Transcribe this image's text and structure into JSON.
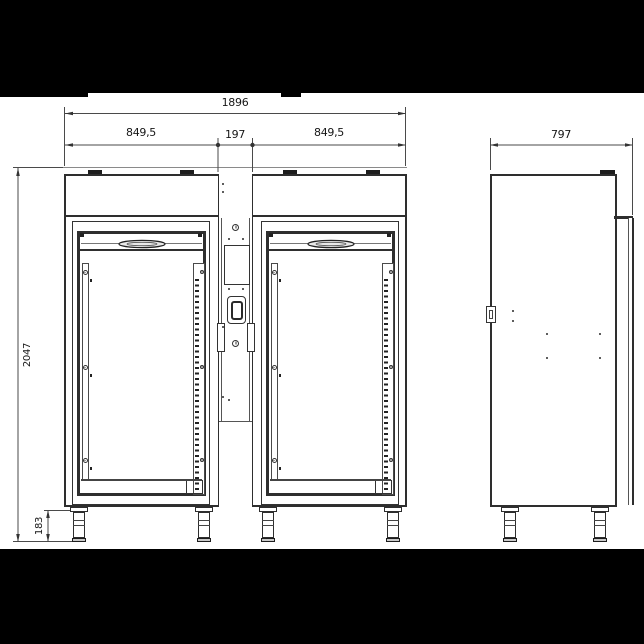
{
  "drawing": {
    "type": "technical-dimension-drawing",
    "views": {
      "front": "front-view",
      "side": "side-view"
    },
    "dimensions": {
      "total_width": "1896",
      "left_section_width": "849,5",
      "center_section_width": "197",
      "right_section_width": "849,5",
      "side_depth": "797",
      "total_height": "2047",
      "leg_height": "183"
    },
    "colors": {
      "ink": "#2e2e2e",
      "letterbox": "#000000",
      "paper": "#ffffff"
    }
  }
}
